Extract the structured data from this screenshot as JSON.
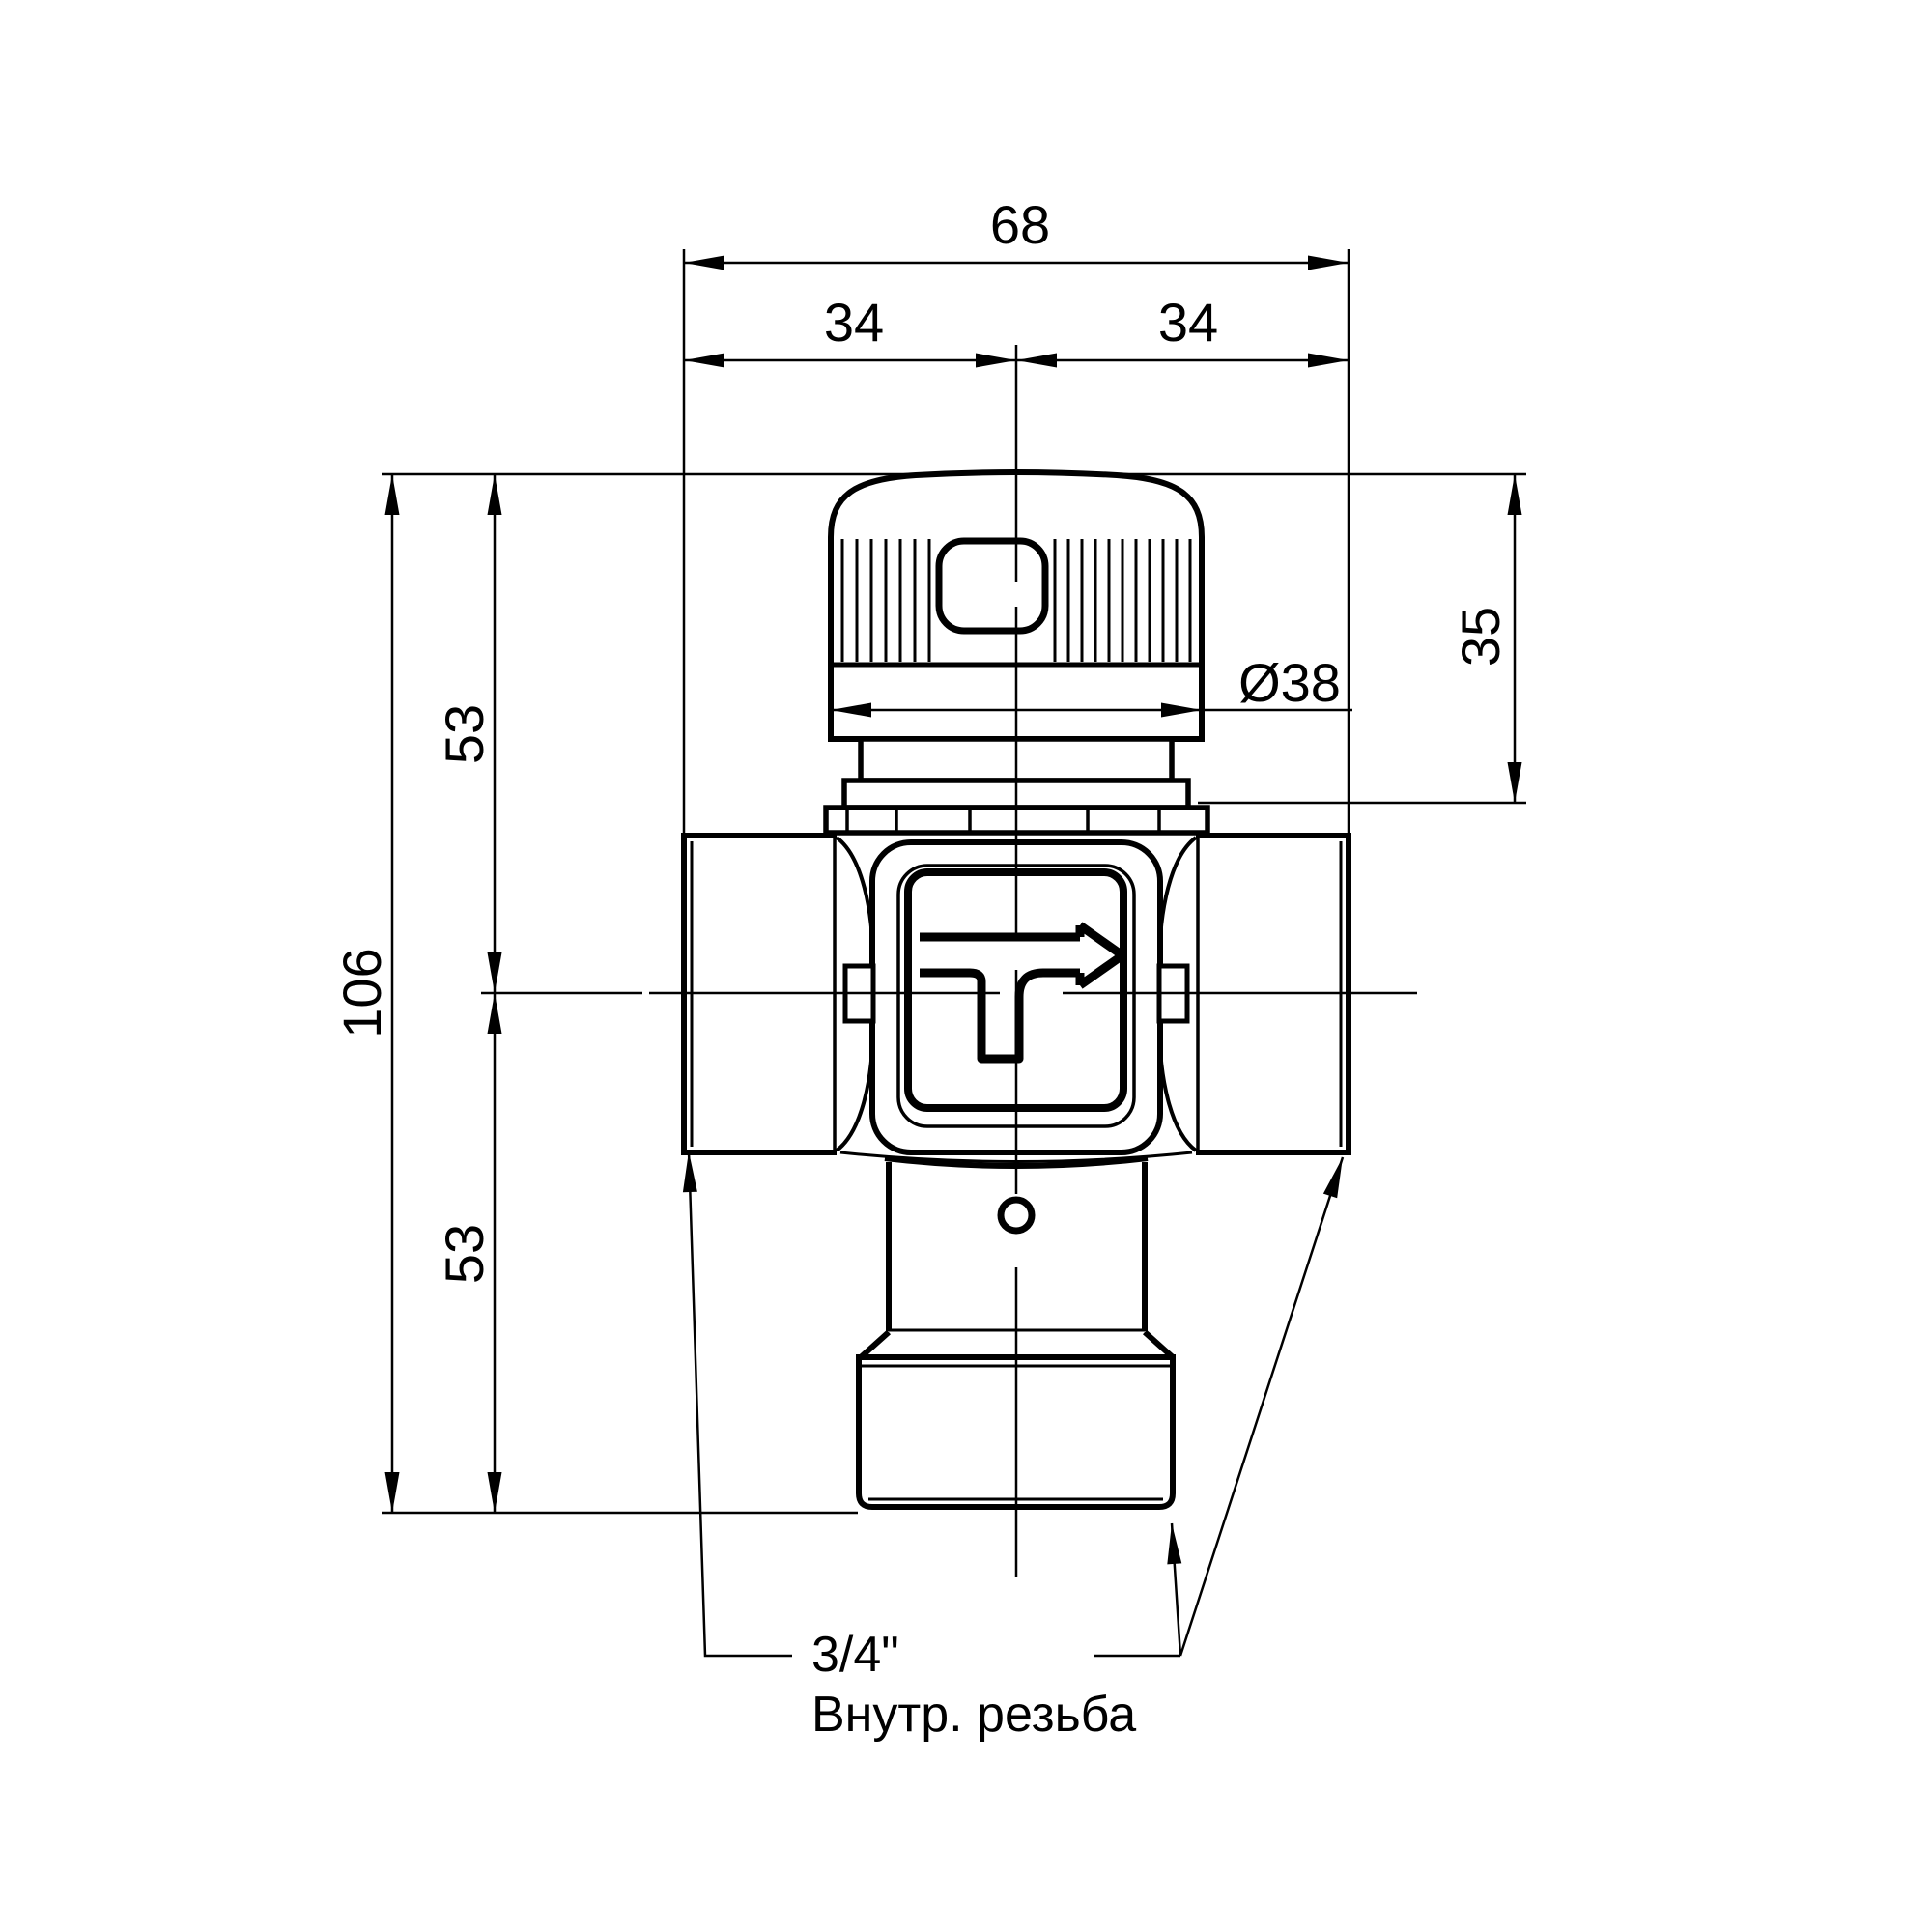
{
  "page": {
    "background": "#ffffff",
    "line_color": "#000000"
  },
  "drawing": {
    "kind": "technical dimension drawing",
    "component": "thermostatic mixing valve, front view",
    "dimensions": {
      "overall_width": {
        "label": "68"
      },
      "width_left_half": {
        "label": "34"
      },
      "width_right_half": {
        "label": "34"
      },
      "overall_height": {
        "label": "106"
      },
      "height_upper_half": {
        "label": "53"
      },
      "height_lower_half": {
        "label": "53"
      },
      "cap_assembly_height": {
        "label": "35"
      },
      "cap_diameter": {
        "label": "Ø38"
      }
    },
    "note": {
      "thread_size": "3/4\"",
      "thread_type": "Внутр. резьба"
    }
  }
}
